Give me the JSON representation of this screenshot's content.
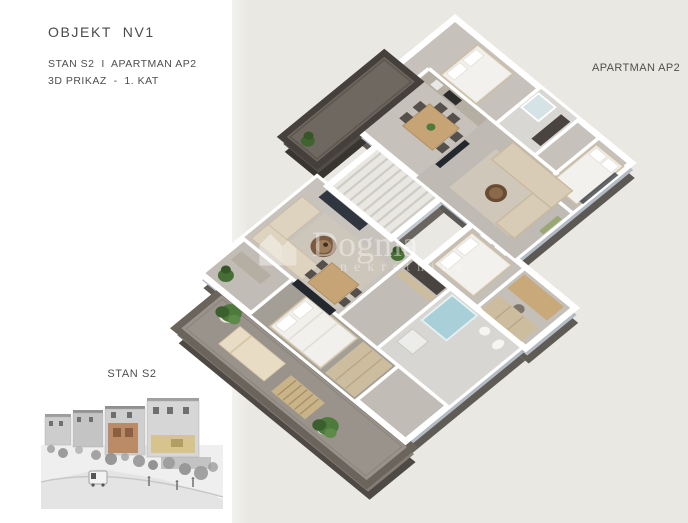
{
  "page": {
    "background_left": "#ffffff",
    "background_right": "#eae8e3",
    "divider_x": 232
  },
  "header": {
    "title": "OBJEKT  NV1",
    "line1": "STAN S2  I  APARTMAN AP2",
    "line2": "3D PRIKAZ  -  1. KAT"
  },
  "floorplan": {
    "label_ap2": "APARTMAN AP2",
    "type": "3d-isometric-cutaway-floor-plan",
    "floor_label": "1. KAT",
    "units": [
      {
        "name": "APARTMAN AP2",
        "position": "upper-right",
        "features": [
          "bedroom",
          "bedroom",
          "bathroom",
          "dining area",
          "living room",
          "dark balcony"
        ]
      },
      {
        "name": "STAN S2",
        "position": "lower-left",
        "features": [
          "living room",
          "dining area",
          "bedroom",
          "bedroom",
          "bathroom with shower",
          "terrace with plants"
        ]
      }
    ],
    "stair_core": "between units"
  },
  "thumbnail": {
    "label": "STAN S2",
    "description": "grayscale street render with highlighted facades",
    "highlight_orange": "#bb8a66",
    "highlight_yellow": "#d6c48c"
  },
  "watermark": {
    "brand": "Dogma",
    "tagline": "nekretnine"
  },
  "colors": {
    "text": "#4a4a48",
    "wall_white": "#ffffff",
    "wall_face_light": "#b4bbc4",
    "wall_face_dark": "#5f5b55",
    "balcony_dark": "#45403b",
    "terrace_frame": "#6b645c",
    "floor_gray": "#c1bdb6",
    "wood": "#c6a476",
    "sofa_beige": "#d8ccb6",
    "bed_white": "#f3f1ed",
    "plant_green": "#4e7a3c",
    "shower_blue": "#a9cfd8",
    "tv_dark": "#23272e"
  }
}
